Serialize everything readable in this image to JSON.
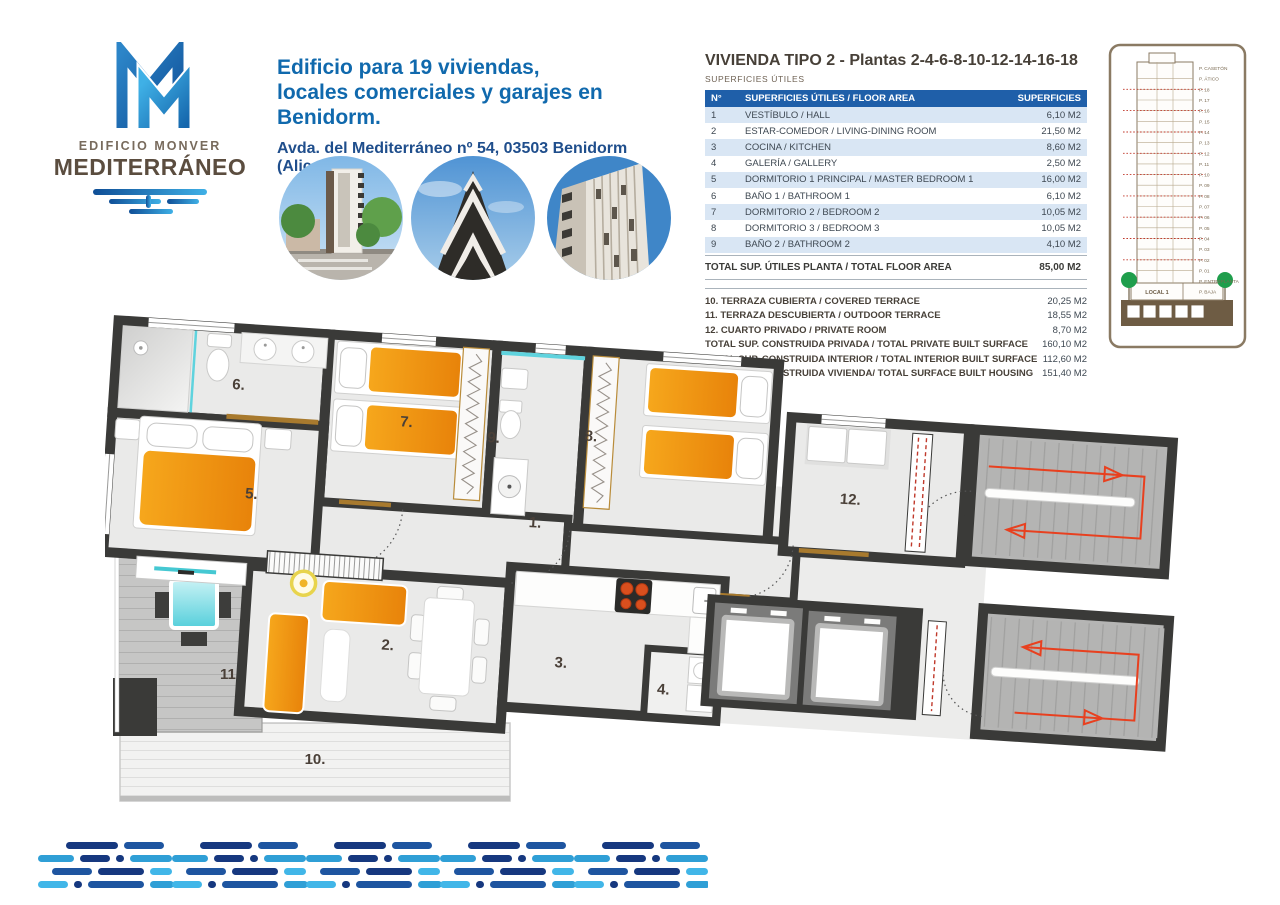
{
  "brand": {
    "logo_line1": "EDIFICIO MONVER",
    "logo_line2": "MEDITERRÁNEO"
  },
  "header": {
    "title_line1": "Edificio para 19 viviendas,",
    "title_line2": "locales comerciales y garajes en Benidorm.",
    "address": "Avda. del Mediterráneo nº 54, 03503 Benidorm (Alicante)"
  },
  "spec": {
    "title": "VIVIENDA TIPO 2",
    "title_suffix": " - Plantas 2-4-6-8-10-12-14-16-18",
    "subtitle": "SUPERFICIES ÚTILES",
    "table": {
      "col_num": "N°",
      "col_name": "SUPERFICIES ÚTILES / FLOOR AREA",
      "col_area": "SUPERFICIES",
      "rows": [
        {
          "num": "1",
          "name": "VESTÍBULO / HALL",
          "area": "6,10 M2"
        },
        {
          "num": "2",
          "name": "ESTAR-COMEDOR / LIVING-DINING ROOM",
          "area": "21,50 M2"
        },
        {
          "num": "3",
          "name": "COCINA / KITCHEN",
          "area": "8,60 M2"
        },
        {
          "num": "4",
          "name": "GALERÍA / GALLERY",
          "area": "2,50 M2"
        },
        {
          "num": "5",
          "name": "DORMITORIO 1 PRINCIPAL / MASTER BEDROOM 1",
          "area": "16,00 M2"
        },
        {
          "num": "6",
          "name": "BAÑO 1 / BATHROOM 1",
          "area": "6,10 M2"
        },
        {
          "num": "7",
          "name": "DORMITORIO 2 / BEDROOM 2",
          "area": "10,05 M2"
        },
        {
          "num": "8",
          "name": "DORMITORIO 3 / BEDROOM 3",
          "area": "10,05 M2"
        },
        {
          "num": "9",
          "name": "BAÑO 2 / BATHROOM 2",
          "area": "4,10 M2"
        }
      ],
      "total_label": "TOTAL SUP. ÚTILES PLANTA / TOTAL FLOOR AREA",
      "total_area": "85,00 M2"
    },
    "extras": [
      {
        "label": "10. TERRAZA CUBIERTA / COVERED TERRACE",
        "area": "20,25 M2"
      },
      {
        "label": "11. TERRAZA DESCUBIERTA / OUTDOOR TERRACE",
        "area": "18,55 M2"
      },
      {
        "label": "12. CUARTO PRIVADO / PRIVATE ROOM",
        "area": "8,70 M2"
      },
      {
        "label": "TOTAL SUP. CONSTRUIDA PRIVADA / TOTAL PRIVATE BUILT SURFACE",
        "area": "160,10 M2"
      },
      {
        "label": "TOTAL SUP. CONSTRUIDA INTERIOR / TOTAL INTERIOR BUILT SURFACE",
        "area": "112,60 M2"
      },
      {
        "label": "TOTAL SUP. CONSTRUIDA VIVIENDA/ TOTAL SURFACE BUILT HOUSING",
        "area": "151,40 M2"
      }
    ]
  },
  "section": {
    "floors": [
      "P. CASETÓN",
      "P. ÁTICO",
      "P. 18",
      "P. 17",
      "P. 16",
      "P. 15",
      "P. 14",
      "P. 13",
      "P. 12",
      "P. 11",
      "P. 10",
      "P. 09",
      "P. 08",
      "P. 07",
      "P. 06",
      "P. 05",
      "P. 04",
      "P. 03",
      "P. 02",
      "P. 01",
      "P. ENTREPLANTA",
      "P. BAJA"
    ],
    "local_label": "LOCAL 1"
  },
  "plan": {
    "rooms": [
      "1.",
      "2.",
      "3.",
      "4.",
      "5.",
      "6.",
      "7.",
      "8.",
      "9.",
      "10.",
      "11.",
      "12."
    ]
  },
  "colors": {
    "table_header_blue": "#1f5fa9",
    "table_row_blue": "#d9e6f4",
    "heading_blue": "#1069ad",
    "address_navy": "#1f4e8c",
    "brand_brown": "#5b4d3f",
    "wall_dark": "#3a3a38",
    "furniture_orange": "#f09a12",
    "stair_red": "#e8401f",
    "accent_cyan": "#5fd3de",
    "sill_brown": "#a87a2e",
    "tree_green": "#1f9e4c"
  }
}
